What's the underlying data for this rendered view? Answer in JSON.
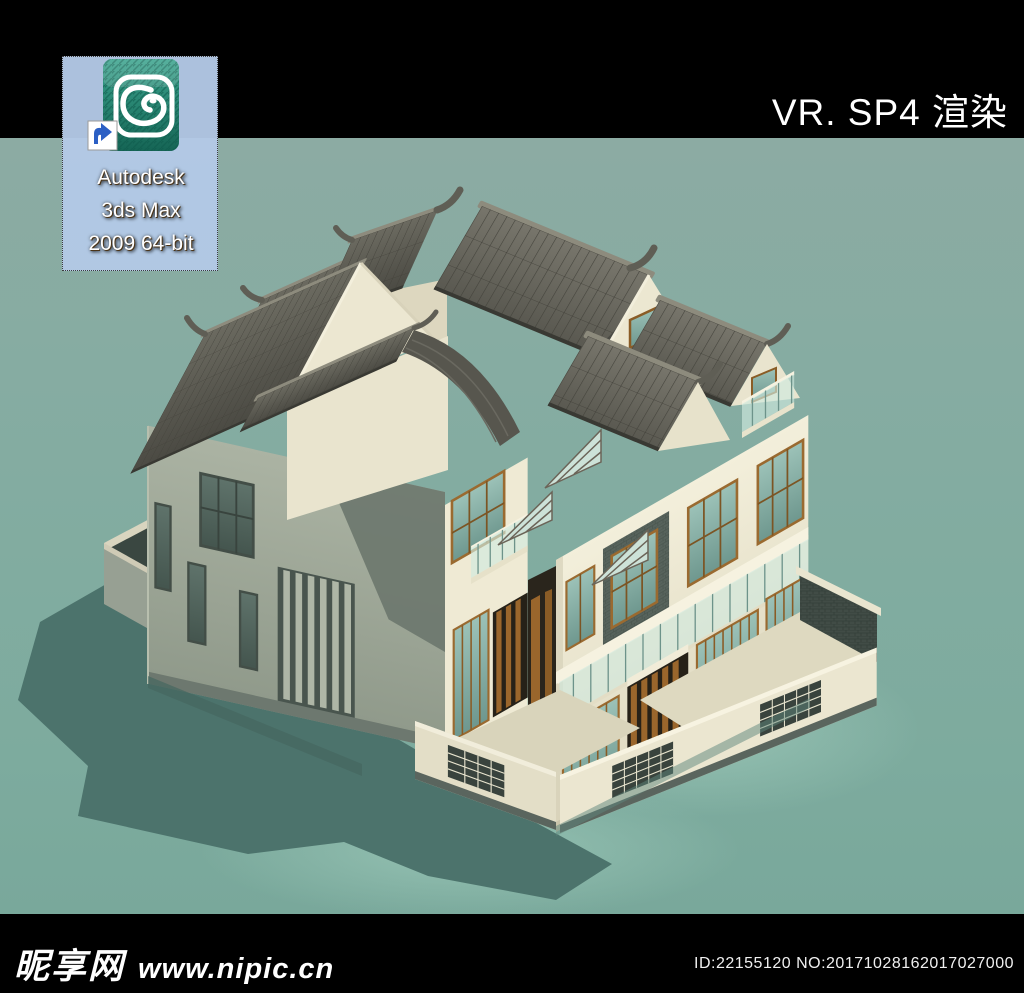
{
  "top_bar": {
    "render_label": "VR. SP4 渲染"
  },
  "desktop": {
    "icon": {
      "label_line1": "Autodesk",
      "label_line2": "3ds Max",
      "label_line3": "2009 64-bit",
      "selected": true
    }
  },
  "footer": {
    "watermark_site_name": "昵享网",
    "watermark_site_url": "www.nipic.cn",
    "image_id": "ID:22155120 NO:20171028162017027000"
  },
  "icons": {
    "app_icon": "autodesk-3dsmax-logo-icon",
    "shortcut_overlay": "shortcut-arrow-icon"
  },
  "colors": {
    "bar_black": "#000000",
    "title_text": "#FFFFFF",
    "background_teal": "#82ABA0",
    "ground_shadow_teal": "#4C736C",
    "selection_blue": "#B3C9E6",
    "icon_teal": "#2E8D7C",
    "shortcut_arrow_blue": "#2B5FC4",
    "roof_tile_gray": "#57564E",
    "roof_ridge_gray": "#8D8B7D",
    "wall_cream_lit": "#F0EBD6",
    "wall_shaded_green": "#A4AC9C",
    "gable_cream": "#ECE7D1",
    "brick_panel_gray": "#57635C",
    "window_frame_brown": "#9A6A30",
    "window_glass_teal": "#7FB2A8",
    "balcony_glass": "#CFE9DF",
    "wood_slat_brown": "#9A662C",
    "watermark_text": "#FFFFFF"
  }
}
